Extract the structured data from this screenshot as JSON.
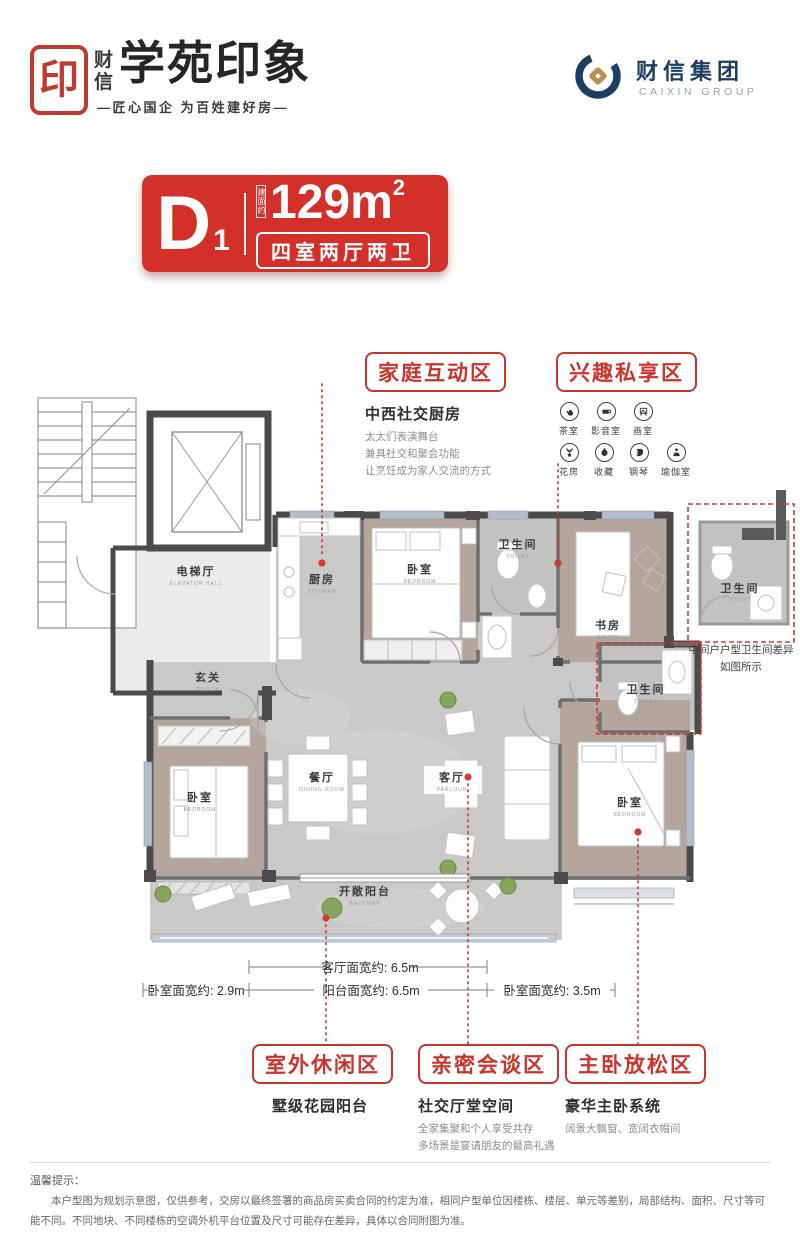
{
  "header": {
    "seal_char": "印",
    "brand_vertical": "财信",
    "title": "学苑印象",
    "tagline": "—匠心国企 为百姓建好房—",
    "group": {
      "name": "财信集团",
      "en": "CAIXIN GROUP"
    }
  },
  "badge": {
    "unit": "D",
    "unit_sub": "1",
    "area_label": "建面约",
    "area_value": "129m",
    "area_sup": "2",
    "layout": "四室两厅两卫",
    "bg_color": "#d3302a"
  },
  "callouts": {
    "family": {
      "title": "家庭互动区",
      "subtitle": "中西社交厨房",
      "lines": [
        "太太们表演舞台",
        "兼具社交和聚会功能",
        "让烹饪成为家人交流的方式"
      ]
    },
    "hobby": {
      "title": "兴趣私享区",
      "row1": [
        {
          "icon": "teapot-icon",
          "label": "茶室"
        },
        {
          "icon": "projector-icon",
          "label": "影音室"
        },
        {
          "icon": "easel-icon",
          "label": "画室"
        }
      ],
      "row2": [
        {
          "icon": "plant-icon",
          "label": "花房"
        },
        {
          "icon": "vase-icon",
          "label": "收藏"
        },
        {
          "icon": "piano-icon",
          "label": "钢琴"
        },
        {
          "icon": "yoga-icon",
          "label": "瑜伽室"
        }
      ]
    },
    "outdoor": {
      "title": "室外休闲区",
      "subtitle": "墅级花园阳台"
    },
    "social": {
      "title": "亲密会谈区",
      "subtitle": "社交厅堂空间",
      "lines": [
        "全家集聚和个人享受共存",
        "多场景是宴请朋友的最高礼遇"
      ]
    },
    "master": {
      "title": "主卧放松区",
      "subtitle": "豪华主卧系统",
      "lines": [
        "阔景大飘窗、宽阔衣帽间"
      ]
    }
  },
  "floorplan": {
    "rooms": {
      "elevator_hall": {
        "cn": "电梯厅",
        "en": "ELEVATOR HALL"
      },
      "porch": {
        "cn": "玄关",
        "en": "PORCH"
      },
      "kitchen": {
        "cn": "厨房",
        "en": "KITCHEN"
      },
      "bedroom_top": {
        "cn": "卧室",
        "en": "BEDROOM"
      },
      "toilet_top": {
        "cn": "卫生间",
        "en": "TOILET"
      },
      "study": {
        "cn": "书房",
        "en": "STUDY"
      },
      "toilet_mid": {
        "cn": "卫生间",
        "en": "TOILET"
      },
      "dining": {
        "cn": "餐厅",
        "en": "DINING ROOM"
      },
      "living": {
        "cn": "客厅",
        "en": "PARLOUR"
      },
      "bedroom_left": {
        "cn": "卧室",
        "en": "BEDROOM"
      },
      "bedroom_master": {
        "cn": "卧室",
        "en": "BEDROOM"
      },
      "balcony": {
        "cn": "开敞阳台",
        "en": "BALCONY"
      },
      "toilet_inset": {
        "cn": "卫生间",
        "en": "TOILET"
      }
    },
    "inset_note": [
      "中间户户型卫生间差异",
      "如图所示"
    ]
  },
  "dimensions": {
    "living": "客厅面宽约: 6.5m",
    "balcony": "阳台面宽约: 6.5m",
    "bedroom_left": "卧室面宽约: 2.9m",
    "bedroom_master": "卧室面宽约: 3.5m"
  },
  "disclaimer": {
    "label": "温馨提示：",
    "text": "本户型图为规划示意图，仅供参考，交房以最终签署的商品房买卖合同的约定为准，相同户型单位因楼栋、楼层、单元等差别，局部结构、面积、尺寸等可能不同。不同地块、不同楼栋的空调外机平台位置及尺寸可能存在差异，具体以合同附图为准。"
  },
  "colors": {
    "brand_red": "#d3302a",
    "navy": "#1e3d63",
    "gold": "#b3914e"
  }
}
